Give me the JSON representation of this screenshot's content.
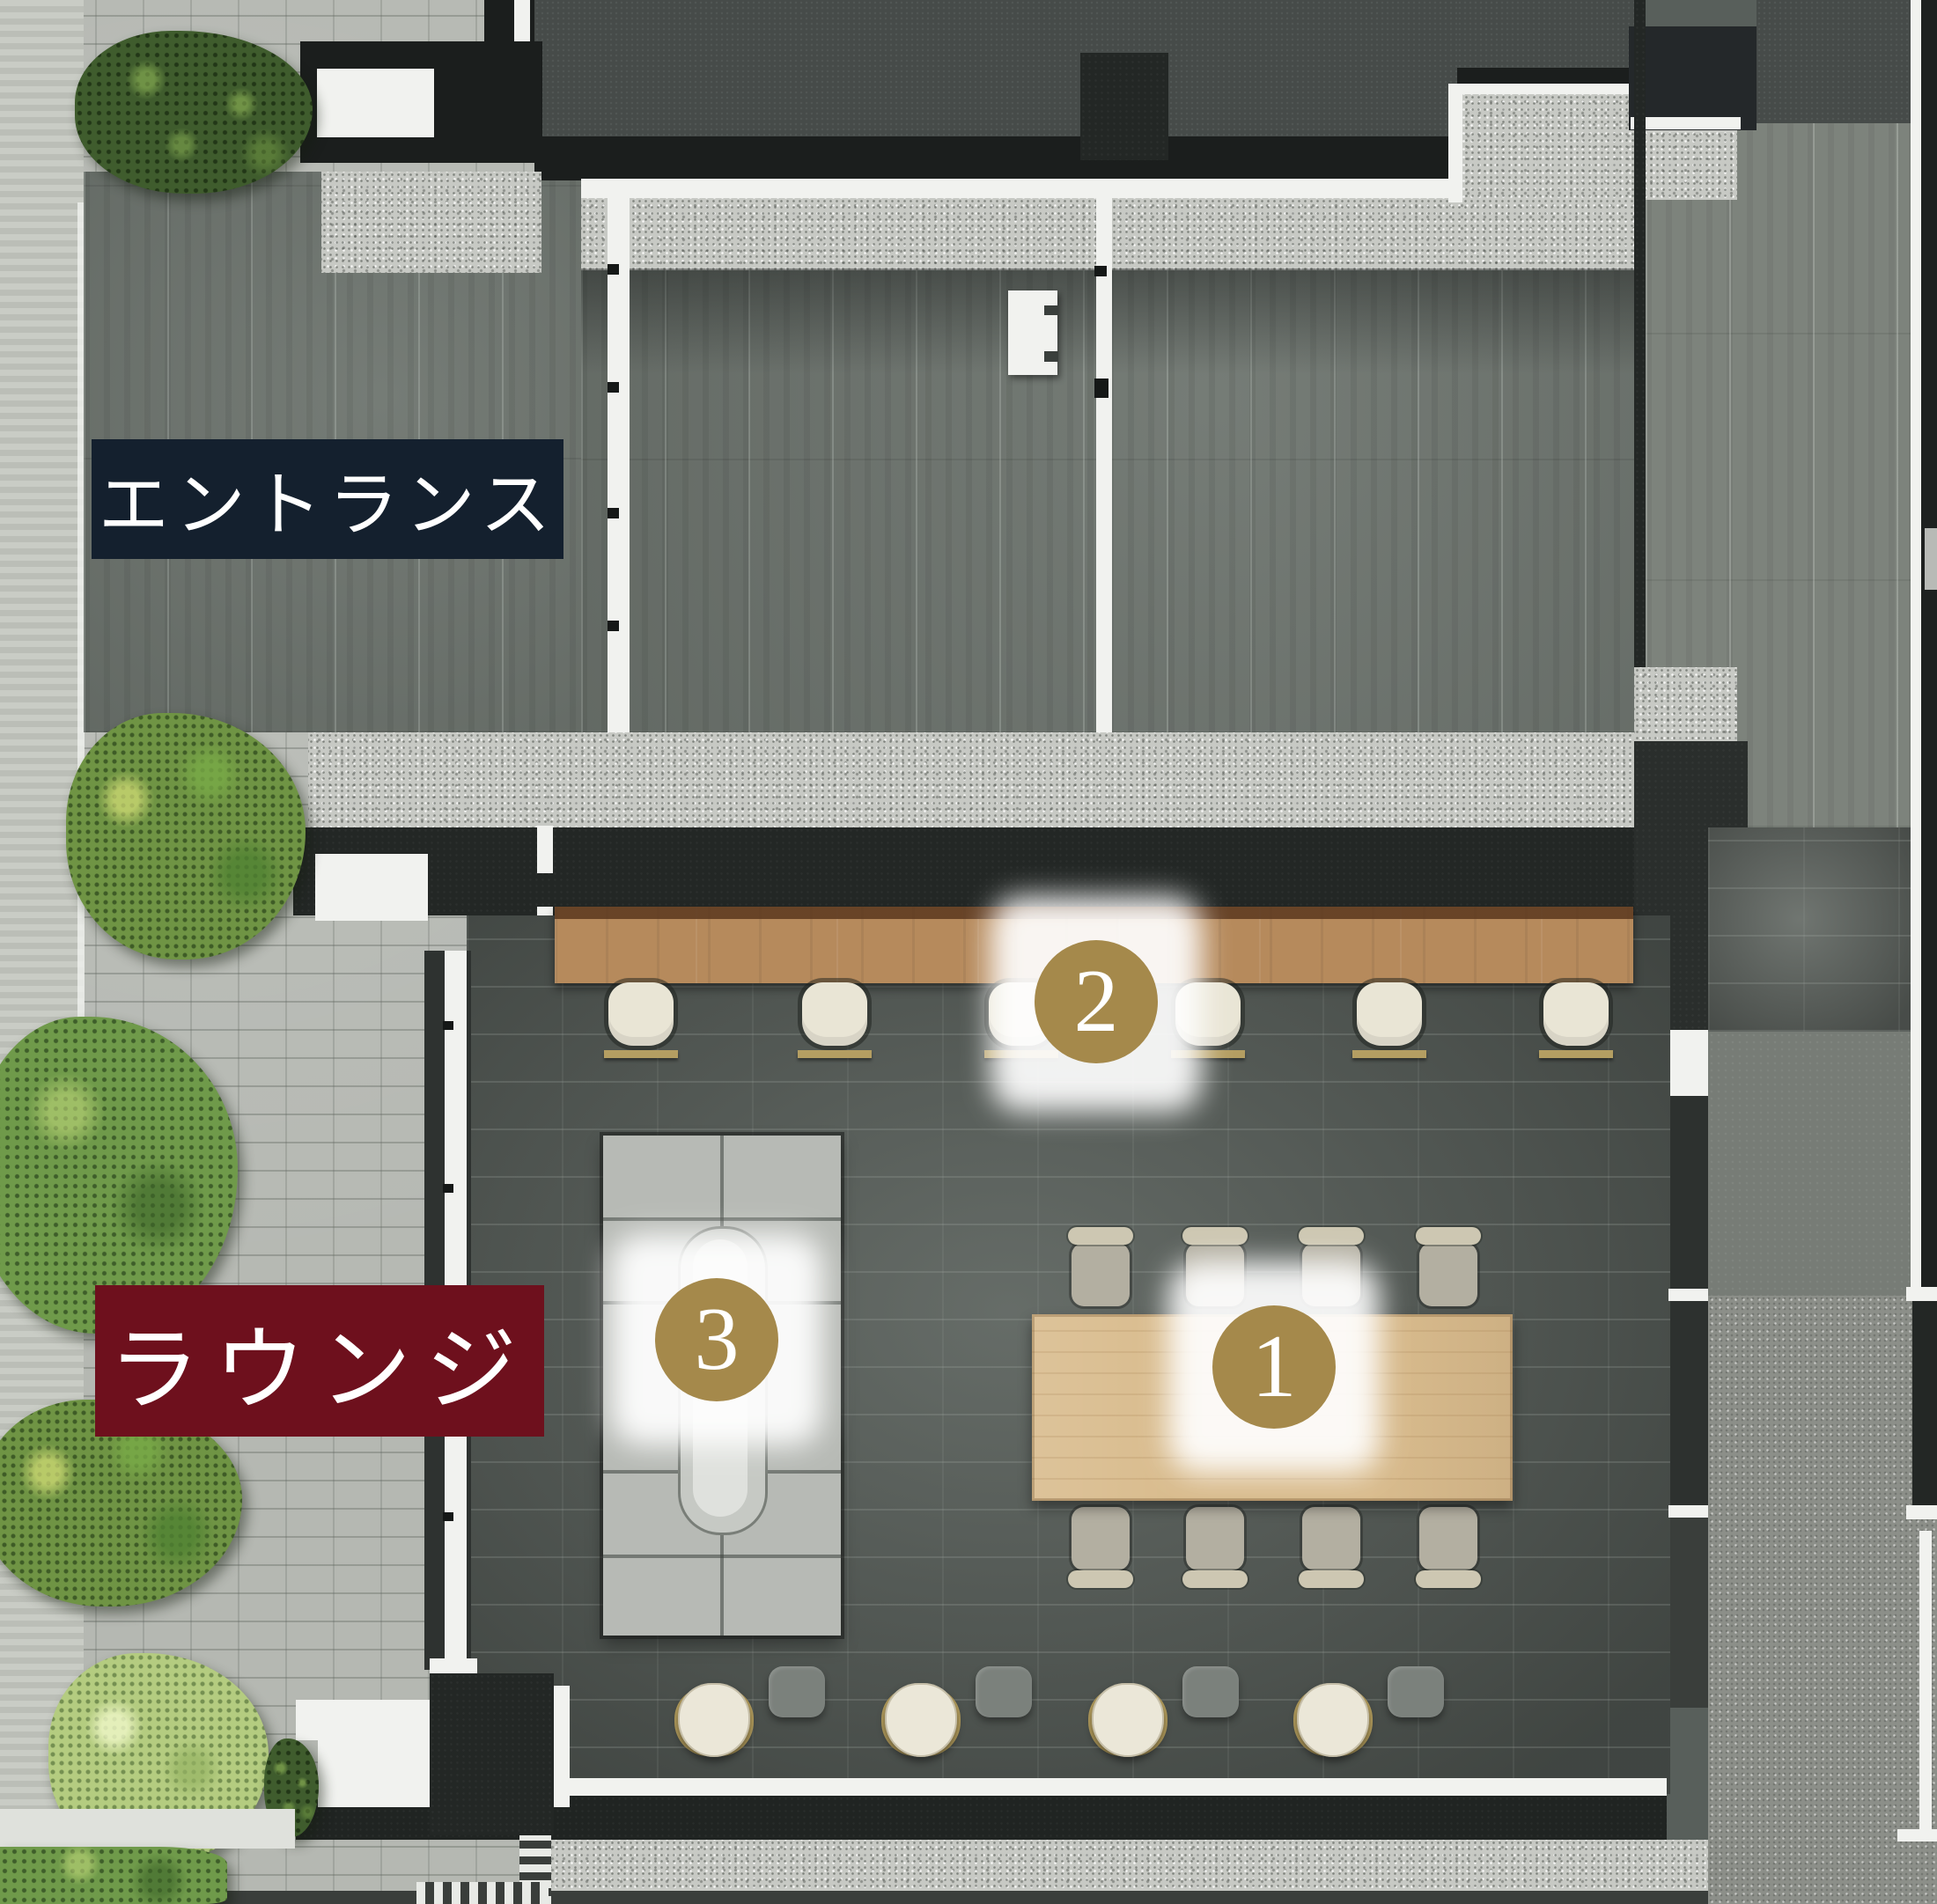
{
  "areas": [
    {
      "id": "entrance",
      "label": "エントランス",
      "label_bg": "#14202e",
      "label_fg": "#ffffff"
    },
    {
      "id": "lounge",
      "label": "ラウンジ",
      "label_bg": "#6e101d",
      "label_fg": "#ffffff"
    }
  ],
  "markers": [
    {
      "number": "1",
      "shape": "circle",
      "bg": "#a5894b",
      "fg": "#ffffff"
    },
    {
      "number": "2",
      "shape": "circle",
      "bg": "#a5894b",
      "fg": "#ffffff"
    },
    {
      "number": "3",
      "shape": "circle",
      "bg": "#a5894b",
      "fg": "#ffffff"
    }
  ],
  "furniture": {
    "counter_stools": 6,
    "dining_tables": 1,
    "dining_chairs": 8,
    "sofa_sets": 1,
    "lounge_chairs": 4,
    "side_tables": 4
  },
  "palette": {
    "marker_gold": "#a5894b",
    "entrance_label_bg": "#14202e",
    "lounge_label_bg": "#6e101d",
    "label_text": "#ffffff",
    "counter_wood": "#b68a5c",
    "table_wood": "#d9bc8e",
    "plank_floor": "#6e756f",
    "stone_tile_floor": "#59605b",
    "granite": "#c7c9c4",
    "pavement": "#b5b8b2",
    "wall_charcoal": "#232725",
    "trim_white": "#f1f2ef",
    "hedge_green": "#3f5c2d"
  }
}
